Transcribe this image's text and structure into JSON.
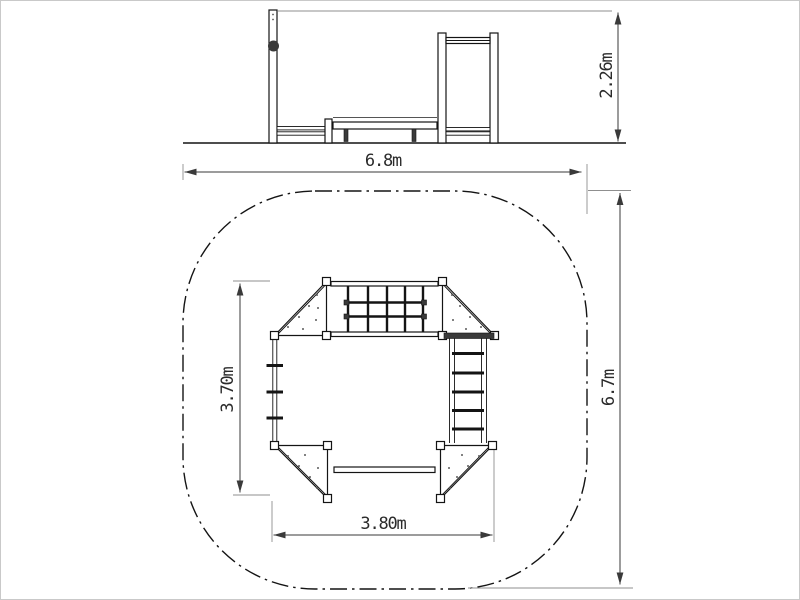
{
  "page": {
    "background": "#ffffff",
    "border_color": "#c9c9c9",
    "type_label": "playground-equipment-dimension-drawing"
  },
  "colors": {
    "structure_line": "#141414",
    "dimension_line": "#3a3a3a",
    "extension_line": "#8f8f8f",
    "dark_fill": "#3a3a3a",
    "text": "#2b2b2b",
    "background": "#ffffff"
  },
  "elevation_view": {
    "height_dimension": {
      "label": "2.26m"
    }
  },
  "plan_view": {
    "dimensions": {
      "safety_zone_width": {
        "label": "6.8m"
      },
      "safety_zone_depth": {
        "label": "6.7m"
      },
      "platform_span_width": {
        "label": "3.80m"
      },
      "platform_span_depth": {
        "label": "3.70m"
      }
    }
  }
}
